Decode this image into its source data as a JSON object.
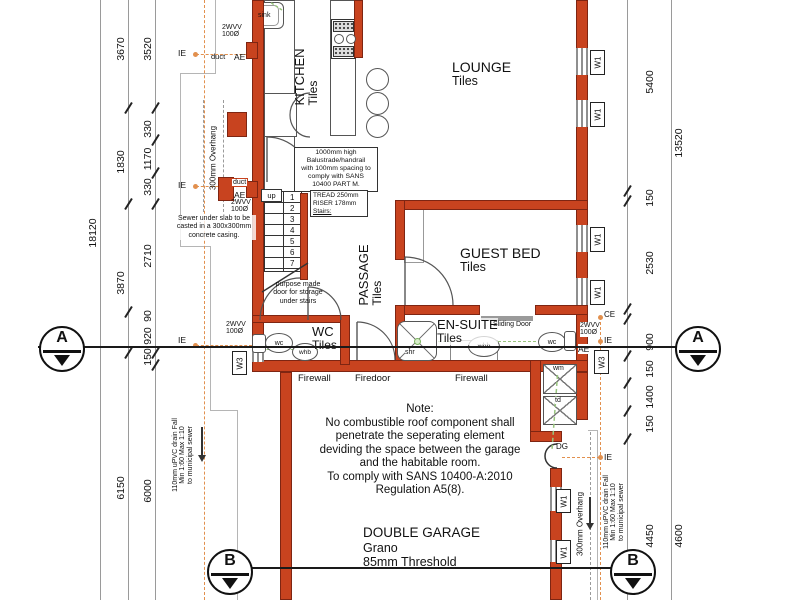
{
  "rooms": {
    "kitchen": {
      "name": "KITCHEN",
      "finish": "Tiles"
    },
    "lounge": {
      "name": "LOUNGE",
      "finish": "Tiles"
    },
    "guest_bed": {
      "name": "GUEST BED",
      "finish": "Tiles"
    },
    "passage": {
      "name": "PASSAGE",
      "finish": "Tiles"
    },
    "wc": {
      "name": "WC",
      "finish": "Tiles"
    },
    "ensuite": {
      "name": "EN-SUITE",
      "finish": "Tiles"
    },
    "garage": {
      "name": "DOUBLE GARAGE",
      "floor": "Grano",
      "threshold": "85mm Threshold"
    }
  },
  "dimensions": {
    "left_outer_total": "18120",
    "left_mid": [
      "3670",
      "1830",
      "3870",
      "6150"
    ],
    "left_inner": [
      "3520",
      "330",
      "1170",
      "330",
      "2710",
      "90",
      "920",
      "150",
      "6000"
    ],
    "right_inner": [
      "5400",
      "150",
      "2530",
      "900",
      "150",
      "1400",
      "150",
      "4450"
    ],
    "right_outer": [
      "13520",
      "4600"
    ]
  },
  "labels": {
    "ie": "IE",
    "ae": "AE",
    "ce": "CE",
    "duct": "duct",
    "dg": "DG",
    "up": "up",
    "vent_l1": "2WVV",
    "vent_l2": "100Ø",
    "w1": "W1",
    "w3": "W3",
    "sink": "sink",
    "wc": "wc",
    "whb": "whb",
    "shr": "shr",
    "wm": "wm",
    "td": "td",
    "firewall": "Firewall",
    "firedoor": "Firedoor",
    "sliding_door": "Sliding Door",
    "overhang": "300mm Overhang"
  },
  "stairs": {
    "numbers": [
      "1",
      "2",
      "3",
      "4",
      "5",
      "6",
      "7"
    ],
    "spec": [
      "TREAD 250mm",
      "RISER 178mm",
      "Stairs:"
    ]
  },
  "notes": {
    "balustrade": [
      "1000mm high",
      "Balustrade/handrail",
      "with 100mm spacing to",
      "comply with SANS",
      "10400 PART M."
    ],
    "sewer_slab": [
      "Sewer under slab to be",
      "casted in a 300x300mm",
      "concrete casing."
    ],
    "storage_door": [
      "purpose made",
      "door for storage",
      "under stairs"
    ],
    "garage_note": [
      "Note:",
      "No combustible roof component shall",
      "penetrate the seperating element",
      "deviding the space between the garage",
      "and the habitable room.",
      "To comply with SANS 10400-A:2010",
      "Regulation A5(8)."
    ],
    "drain": [
      "110mm uPVC drain Fall",
      "Min 1:60 Max 1:10",
      "to municipal sewer"
    ]
  },
  "section_markers": {
    "a": "A",
    "b": "B"
  },
  "colors": {
    "wall": "#c8431f",
    "window_frame": "#8f8f8f",
    "sewer_line": "#e2904e",
    "waste_line": "#98c57d"
  }
}
